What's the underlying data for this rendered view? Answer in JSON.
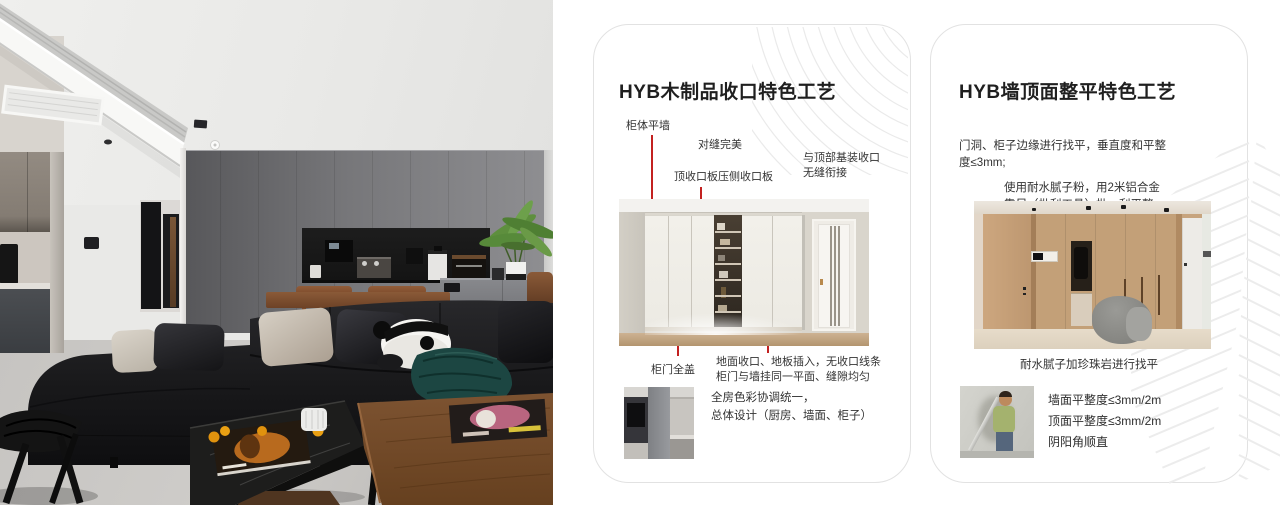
{
  "colors": {
    "accent_red": "#c32120",
    "card_border": "#e2e2e2"
  },
  "photo": {
    "description": "living-room-interior-photo"
  },
  "cards": [
    {
      "title": "HYB木制品收口特色工艺",
      "callout_cabinet": "柜体平墙",
      "callout_seam": "对缝完美",
      "callout_topboard": "顶收口板压侧收口板",
      "callout_topjoint1": "与顶部基装收口",
      "callout_topjoint2": "无缝衔接",
      "callout_door": "柜门全盖",
      "note1": "地面收口、地板插入，无收口线条",
      "note2": "柜门与墙挂同一平面、缝隙均匀",
      "summary1": "全房色彩协调统一，",
      "summary2": "总体设计（厨房、墙面、柜子）"
    },
    {
      "title": "HYB墙顶面整平特色工艺",
      "para1a": "门洞、柜子边缘进行找平，垂直度和平整",
      "para1b": "度≤3mm;",
      "para2a": "使用耐水腻子粉，用2米铝合金",
      "para2b": "靠尺（批刮工具）批、刮平整。",
      "caption": "耐水腻子加珍珠岩进行找平",
      "bullet1": "墙面平整度≤3mm/2m",
      "bullet2": "顶面平整度≤3mm/2m",
      "bullet3": "阴阳角顺直"
    }
  ]
}
